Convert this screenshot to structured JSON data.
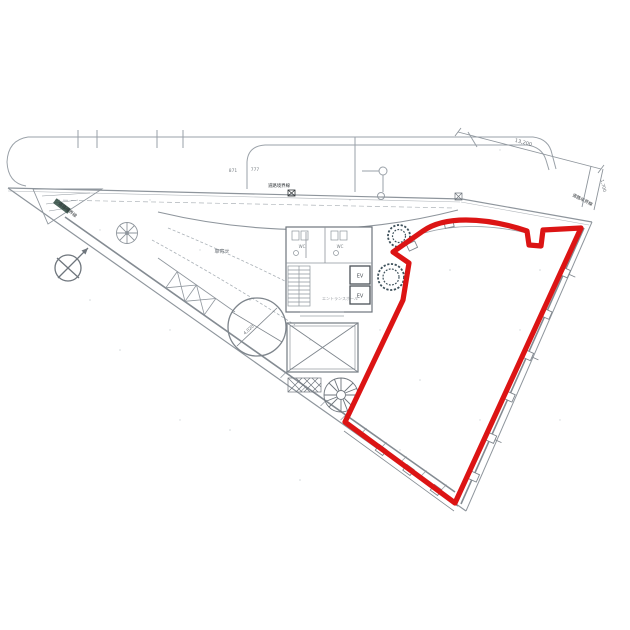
{
  "colors": {
    "paper": "#ffffff",
    "linework": "#8e959c",
    "linework_dark": "#4c5257",
    "red_outline": "#dc1414",
    "tree": "#3f525c",
    "planter": "#2e4a3f"
  },
  "core": {
    "elevator_label": "EV",
    "wc_label": "WC",
    "entrance_hall_label": "エントランスホール"
  },
  "site": {
    "porte_cochere_label": "車寄せ",
    "boundary_label": "道路境界線",
    "turntable_diameter": "4,020"
  },
  "dimensions": {
    "top_center_a": "871",
    "top_center_b": "777",
    "northeast_edge": "13,200",
    "east_offset": "1,700"
  }
}
